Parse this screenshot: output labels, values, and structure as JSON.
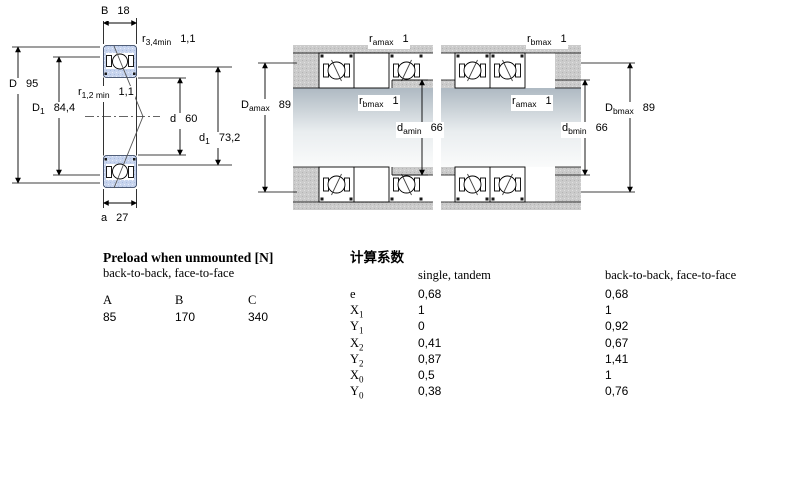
{
  "drawing": {
    "b": {
      "sym": "B",
      "val": "18"
    },
    "r34": {
      "sym": "r",
      "sub": "3,4min",
      "val": "1,1"
    },
    "D": {
      "sym": "D",
      "val": "95"
    },
    "D1": {
      "sym": "D",
      "sub": "1",
      "val": "84,4"
    },
    "r12": {
      "sym": "r",
      "sub": "1,2 min",
      "val": "1,1"
    },
    "d": {
      "sym": "d",
      "val": "60"
    },
    "d1": {
      "sym": "d",
      "sub": "1",
      "val": "73,2"
    },
    "a": {
      "sym": "a",
      "val": "27"
    }
  },
  "arrangement1": {
    "ramax": {
      "sym": "r",
      "sub": "amax",
      "val": "1"
    },
    "Damax": {
      "sym": "D",
      "sub": "amax",
      "val": "89"
    },
    "rbmax": {
      "sym": "r",
      "sub": "bmax",
      "val": "1"
    },
    "damin": {
      "sym": "d",
      "sub": "amin",
      "val": "66"
    }
  },
  "arrangement2": {
    "rbmax": {
      "sym": "r",
      "sub": "bmax",
      "val": "1"
    },
    "ramax": {
      "sym": "r",
      "sub": "amax",
      "val": "1"
    },
    "dbmin": {
      "sym": "d",
      "sub": "bmin",
      "val": "66"
    },
    "Dbmax": {
      "sym": "D",
      "sub": "bmax",
      "val": "89"
    }
  },
  "preload": {
    "title": "Preload when unmounted [N]",
    "subtitle": "back-to-back, face-to-face",
    "columns": [
      "A",
      "B",
      "C"
    ],
    "values": [
      "85",
      "170",
      "340"
    ]
  },
  "factors": {
    "title": "计算系数",
    "col_single": "single, tandem",
    "col_paired": "back-to-back, face-to-face",
    "rows": [
      {
        "sym": "e",
        "sub": "",
        "single": "0,68",
        "paired": "0,68"
      },
      {
        "sym": "X",
        "sub": "1",
        "single": "1",
        "paired": "1"
      },
      {
        "sym": "Y",
        "sub": "1",
        "single": "0",
        "paired": "0,92"
      },
      {
        "sym": "X",
        "sub": "2",
        "single": "0,41",
        "paired": "0,67"
      },
      {
        "sym": "Y",
        "sub": "2",
        "single": "0,87",
        "paired": "1,41"
      },
      {
        "sym": "X",
        "sub": "0",
        "single": "0,5",
        "paired": "1"
      },
      {
        "sym": "Y",
        "sub": "0",
        "single": "0,38",
        "paired": "0,76"
      }
    ]
  },
  "colors": {
    "ring_fill": "#c7d4ee",
    "housing_gray": "#cbcbcb",
    "outline": "#000000"
  }
}
